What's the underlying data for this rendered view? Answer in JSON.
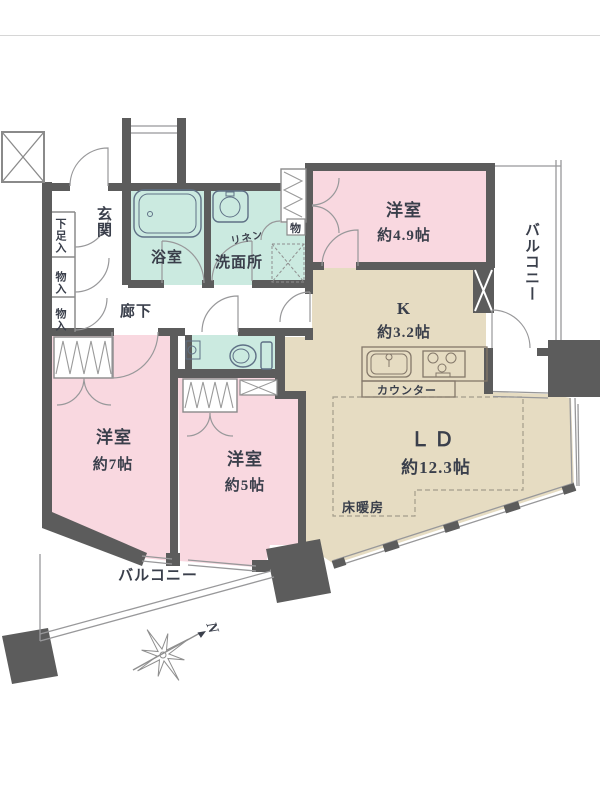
{
  "plan": {
    "entrance": {
      "label": "玄関"
    },
    "shoe_cupboard": {
      "label": "下足入"
    },
    "storage_top": {
      "label": "物入"
    },
    "storage_bottom": {
      "label": "物入"
    },
    "bathroom": {
      "label": "浴室"
    },
    "linen": {
      "label": "リネン"
    },
    "washroom": {
      "label": "洗面所"
    },
    "hallway": {
      "label": "廊下"
    },
    "closet_small": {
      "label": "物"
    },
    "bedroom_east": {
      "name": "洋室",
      "area": "約4.9帖"
    },
    "kitchen": {
      "name": "K",
      "area": "約3.2帖"
    },
    "counter": {
      "label": "カウンター"
    },
    "living_dining": {
      "name": "ＬＤ",
      "area": "約12.3帖"
    },
    "floor_heating": {
      "label": "床暖房"
    },
    "bedroom_west": {
      "name": "洋室",
      "area": "約7帖"
    },
    "bedroom_south": {
      "name": "洋室",
      "area": "約5帖"
    },
    "balcony_east": {
      "label": "バルコニー"
    },
    "balcony_south": {
      "label": "バルコニー"
    },
    "compass": {
      "label": "N"
    }
  },
  "colors": {
    "wall": "#5c5c5c",
    "room_pink": "#f9d8e0",
    "room_teal": "#cbeae0",
    "room_beige": "#e6dcc2",
    "thin_line": "#98989a",
    "text": "#3a3f4b"
  }
}
